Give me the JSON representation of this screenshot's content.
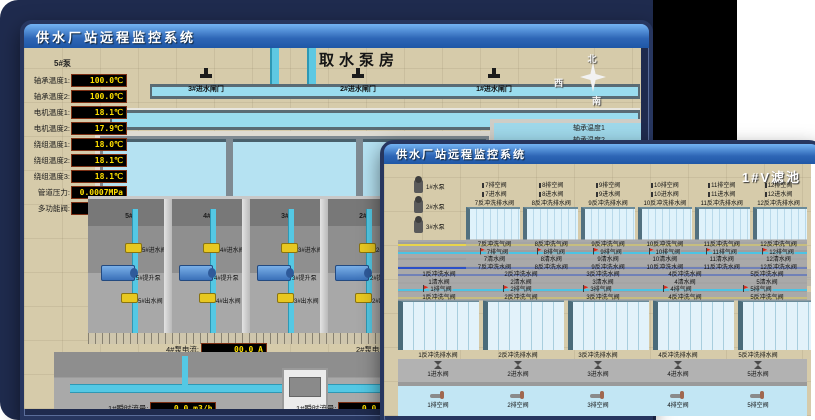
{
  "back_window": {
    "title": "供水厂站远程监控系统",
    "room_title": "取水泵房",
    "pump_panel": {
      "pump_label": "5#泵",
      "readouts": [
        {
          "label": "轴承温度1:",
          "value": "100.0℃"
        },
        {
          "label": "轴承温度2:",
          "value": "100.0℃"
        },
        {
          "label": "电机温度1:",
          "value": "18.1℃"
        },
        {
          "label": "电机温度2:",
          "value": "17.9℃"
        },
        {
          "label": "绕组温度1:",
          "value": "18.0℃"
        },
        {
          "label": "绕组温度2:",
          "value": "18.1℃"
        },
        {
          "label": "绕组温度3:",
          "value": "18.1℃"
        },
        {
          "label": "管道压力:",
          "value": "0.0007MPa"
        },
        {
          "label": "多功能阀:",
          "value": "0%"
        }
      ]
    },
    "gates": [
      "3#进水闸门",
      "2#进水闸门",
      "1#进水闸门"
    ],
    "compass": {
      "north": "北",
      "west": "西",
      "south": "南"
    },
    "side_labels": [
      "轴承温度1",
      "轴承温度2"
    ],
    "bays": [
      {
        "id": "5#",
        "inlet": "5#进水阀",
        "pump": "5#提升泵",
        "outlet": "5#出水阀"
      },
      {
        "id": "4#",
        "inlet": "4#进水阀",
        "pump": "4#提升泵",
        "outlet": "4#出水阀"
      },
      {
        "id": "3#",
        "inlet": "3#进水阀",
        "pump": "3#提升泵",
        "outlet": "3#出水阀"
      },
      {
        "id": "2#",
        "inlet": "2#进水阀",
        "pump": "2#提升泵",
        "outlet": "2#出水阀"
      }
    ],
    "current_meters": [
      {
        "label": "4#泵电流:",
        "value": "00.0 A"
      },
      {
        "label": "2#泵电流",
        "value": ""
      }
    ],
    "flow_meters": [
      {
        "label": "1#瞬时流量:",
        "value": "0.0 m3/h"
      },
      {
        "label": "1#瞬时流量:",
        "value": "0.0 m3/h"
      }
    ]
  },
  "front_window": {
    "title": "供水厂站远程监控系统",
    "page_title": "1#V滤池",
    "pumps": [
      "1#水泵",
      "2#水泵",
      "3#水泵"
    ],
    "blowers": [
      "1#风机",
      "2#风机",
      "3#风机"
    ],
    "top_filters": [
      {
        "id": "7",
        "drain": "7排空阀",
        "inlet": "7进水阀",
        "bw_drain": "7反冲洗排水阀",
        "bw_air": "7反冲洗气阀",
        "air_release": "7排气阀",
        "clear": "7清水阀",
        "bw_water": "7反冲洗水阀"
      },
      {
        "id": "8",
        "drain": "8排空阀",
        "inlet": "8进水阀",
        "bw_drain": "8反冲洗排水阀",
        "bw_air": "8反冲洗气阀",
        "air_release": "8排气阀",
        "clear": "8清水阀",
        "bw_water": "8反冲洗水阀"
      },
      {
        "id": "9",
        "drain": "9排空阀",
        "inlet": "9进水阀",
        "bw_drain": "9反冲洗排水阀",
        "bw_air": "9反冲洗气阀",
        "air_release": "9排气阀",
        "clear": "9清水阀",
        "bw_water": "9反冲洗水阀"
      },
      {
        "id": "10",
        "drain": "10排空阀",
        "inlet": "10进水阀",
        "bw_drain": "10反冲洗排水阀",
        "bw_air": "10反冲洗气阀",
        "air_release": "10排气阀",
        "clear": "10清水阀",
        "bw_water": "10反冲洗水阀"
      },
      {
        "id": "11",
        "drain": "11排空阀",
        "inlet": "11进水阀",
        "bw_drain": "11反冲洗排水阀",
        "bw_air": "11反冲洗气阀",
        "air_release": "11排气阀",
        "clear": "11清水阀",
        "bw_water": "11反冲洗水阀"
      },
      {
        "id": "12",
        "drain": "12排空阀",
        "inlet": "12进水阀",
        "bw_drain": "12反冲洗排水阀",
        "bw_air": "12反冲洗气阀",
        "air_release": "12排气阀",
        "clear": "12清水阀",
        "bw_water": "12反冲洗水阀"
      }
    ],
    "bottom_filters": [
      {
        "id": "1",
        "drain": "1排空阀",
        "inlet": "1进水阀",
        "bw_drain": "1反冲洗排水阀",
        "bw_air": "1反冲洗气阀",
        "air_release": "1排气阀",
        "clear": "1清水阀",
        "bw_water": "1反冲洗水阀"
      },
      {
        "id": "2",
        "drain": "2排空阀",
        "inlet": "2进水阀",
        "bw_drain": "2反冲洗排水阀",
        "bw_air": "2反冲洗气阀",
        "air_release": "2排气阀",
        "clear": "2清水阀",
        "bw_water": "2反冲洗水阀"
      },
      {
        "id": "3",
        "drain": "3排空阀",
        "inlet": "3进水阀",
        "bw_drain": "3反冲洗排水阀",
        "bw_air": "3反冲洗气阀",
        "air_release": "3排气阀",
        "clear": "3清水阀",
        "bw_water": "3反冲洗水阀"
      },
      {
        "id": "4",
        "drain": "4排空阀",
        "inlet": "4进水阀",
        "bw_drain": "4反冲洗排水阀",
        "bw_air": "4反冲洗气阀",
        "air_release": "4排气阀",
        "clear": "4清水阀",
        "bw_water": "4反冲洗水阀"
      },
      {
        "id": "5",
        "drain": "5排空阀",
        "inlet": "5进水阀",
        "bw_drain": "5反冲洗排水阀",
        "bw_air": "5反冲洗气阀",
        "air_release": "5排气阀",
        "clear": "5清水阀",
        "bw_water": "5反冲洗水阀"
      },
      {
        "id": "6",
        "drain": "6排空阀",
        "inlet": "6进水阀",
        "bw_drain": "6反冲洗排水阀",
        "bw_air": "6反冲洗气阀",
        "air_release": "6排气阀",
        "clear": "6清水阀",
        "bw_water": "6反冲洗水阀"
      }
    ]
  },
  "colors": {
    "desktop": "#1f2b4e",
    "titlebar_top": "#74b4f4",
    "titlebar_bottom": "#1f57a6",
    "value_text": "#ffe000",
    "pipe_cyan": "#54c8e4",
    "pipe_yellow": "#e8d44c",
    "pipe_blue": "#2b50c8",
    "flag_red": "#e02818",
    "ground": "#d6cbaa"
  }
}
